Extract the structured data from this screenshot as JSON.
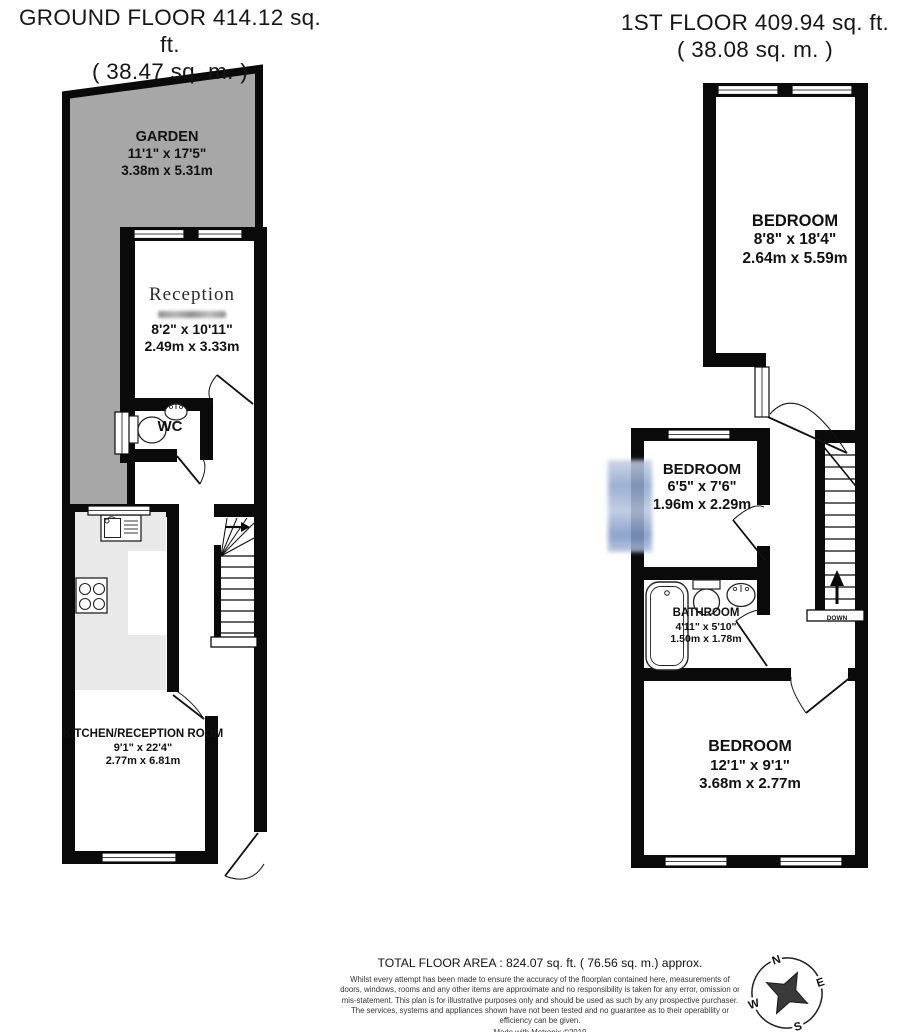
{
  "ground_floor": {
    "title": "GROUND FLOOR 414.12 sq. ft.",
    "subtitle": "( 38.47 sq. m. )",
    "rooms": [
      {
        "name": "GARDEN",
        "dims_ft": "11'1\" x 17'5\"",
        "dims_m": "3.38m x 5.31m"
      },
      {
        "name": "Reception",
        "dims_ft": "8'2\" x 10'11\"",
        "dims_m": "2.49m x 3.33m"
      },
      {
        "name": "WC"
      },
      {
        "name": "KITCHEN/RECEPTION ROOM",
        "dims_ft": "9'1\" x 22'4\"",
        "dims_m": "2.77m x 6.81m"
      }
    ]
  },
  "first_floor": {
    "title": "1ST FLOOR 409.94 sq. ft.",
    "subtitle": "( 38.08 sq. m. )",
    "rooms": [
      {
        "name": "BEDROOM",
        "dims_ft": "8'8\" x 18'4\"",
        "dims_m": "2.64m x 5.59m"
      },
      {
        "name": "BEDROOM",
        "dims_ft": "6'5\" x 7'6\"",
        "dims_m": "1.96m x 2.29m"
      },
      {
        "name": "BATHROOM",
        "dims_ft": "4'11\" x 5'10\"",
        "dims_m": "1.50m x 1.78m"
      },
      {
        "name": "BEDROOM",
        "dims_ft": "12'1\" x 9'1\"",
        "dims_m": "3.68m x 2.77m"
      }
    ],
    "stairs_label": "DOWN"
  },
  "footer": {
    "total_area": "TOTAL FLOOR AREA : 824.07 sq. ft. ( 76.56 sq. m.) approx.",
    "disclaimer": "Whilst every attempt has been made to ensure the accuracy of the floorplan contained here, measurements of doors, windows, rooms and any other items are approximate and no responsibility is taken for any error, omission or mis-statement. This plan is for illustrative purposes only and should be used as such by any prospective purchaser. The services, systems and appliances shown have not been tested and no guarantee as to their operability or efficiency can be given.",
    "credit": "Made with Metropix ©2019"
  },
  "compass": {
    "north": "N",
    "east": "E",
    "south": "S",
    "west": "W"
  },
  "colors": {
    "garden": "#a7a7a7",
    "wall": "#0a0a0a",
    "counter": "#e9e9e9",
    "blur_artifact": "#a9b8d6"
  }
}
